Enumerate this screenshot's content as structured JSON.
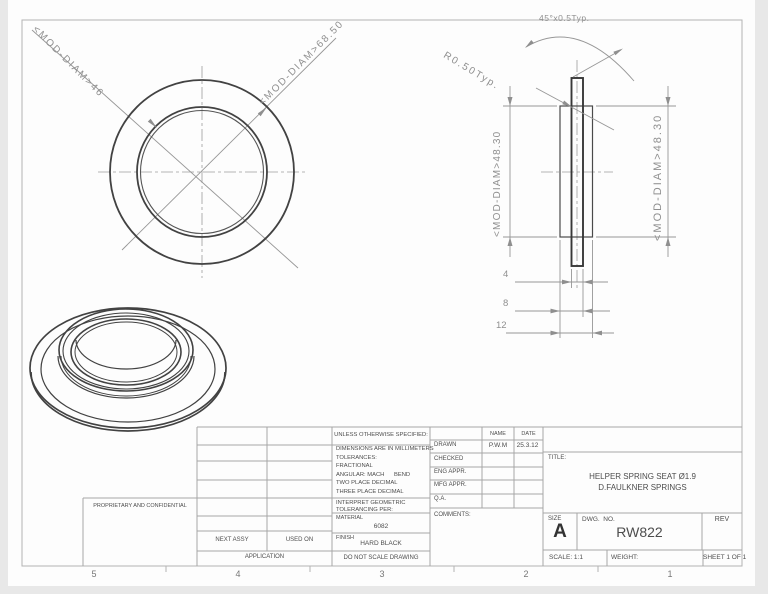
{
  "drawing": {
    "front_view": {
      "dia_outer_label": "<MOD-DIAM>68.50",
      "dia_inner_label": "<MOD-DIAM>46"
    },
    "side_view": {
      "chamfer_label": "45°x0.5Typ.",
      "radius_label": "R0.50Typ.",
      "dia_left_label": "<MOD-DIAM>48.30",
      "dia_right_label": "<MOD-DIAM>48.30",
      "dim_flange": "4",
      "dim_mid": "8",
      "dim_overall": "12"
    }
  },
  "title_block": {
    "proprietary": "PROPRIETARY AND CONFIDENTIAL",
    "next_assy": "NEXT ASSY",
    "used_on": "USED ON",
    "application": "APPLICATION",
    "unless": "UNLESS OTHERWISE SPECIFIED:",
    "tolerance_notes": [
      "DIMENSIONS ARE IN MILLIMETERS",
      "TOLERANCES:",
      "FRACTIONAL",
      "ANGULAR: MACH      BEND ",
      "TWO PLACE DECIMAL    ",
      "THREE PLACE DECIMAL  "
    ],
    "interpret_1": "INTERPRET GEOMETRIC",
    "interpret_2": "TOLERANCING PER:",
    "material_label": "MATERIAL",
    "material_value": "6082",
    "finish_label": "FINISH",
    "finish_value": "HARD BLACK",
    "do_not_scale": "DO NOT SCALE DRAWING",
    "name_header": "NAME",
    "date_header": "DATE",
    "approval_rows": [
      {
        "label": "DRAWN",
        "name": "P.W.M",
        "date": "25.3.12"
      },
      {
        "label": "CHECKED",
        "name": "",
        "date": ""
      },
      {
        "label": "ENG APPR.",
        "name": "",
        "date": ""
      },
      {
        "label": "MFG APPR.",
        "name": "",
        "date": ""
      },
      {
        "label": "Q.A.",
        "name": "",
        "date": ""
      }
    ],
    "comments_label": "COMMENTS:",
    "title_label": "TITLE:",
    "title_line1": "HELPER SPRING SEAT Ø1.9",
    "title_line2": "D.FAULKNER SPRINGS",
    "size_label": "SIZE",
    "size_value": "A",
    "dwg_no_label": "DWG.  NO.",
    "dwg_no_value": "RW822",
    "rev_label": "REV",
    "scale": "SCALE: 1:1",
    "weight": "WEIGHT:",
    "sheet": "SHEET 1 OF 1"
  },
  "border_zones": [
    "5",
    "4",
    "3",
    "2",
    "1"
  ],
  "colors": {
    "edge": "#424242",
    "dim": "#8f8f8f",
    "table_line": "#a6a6a6"
  }
}
